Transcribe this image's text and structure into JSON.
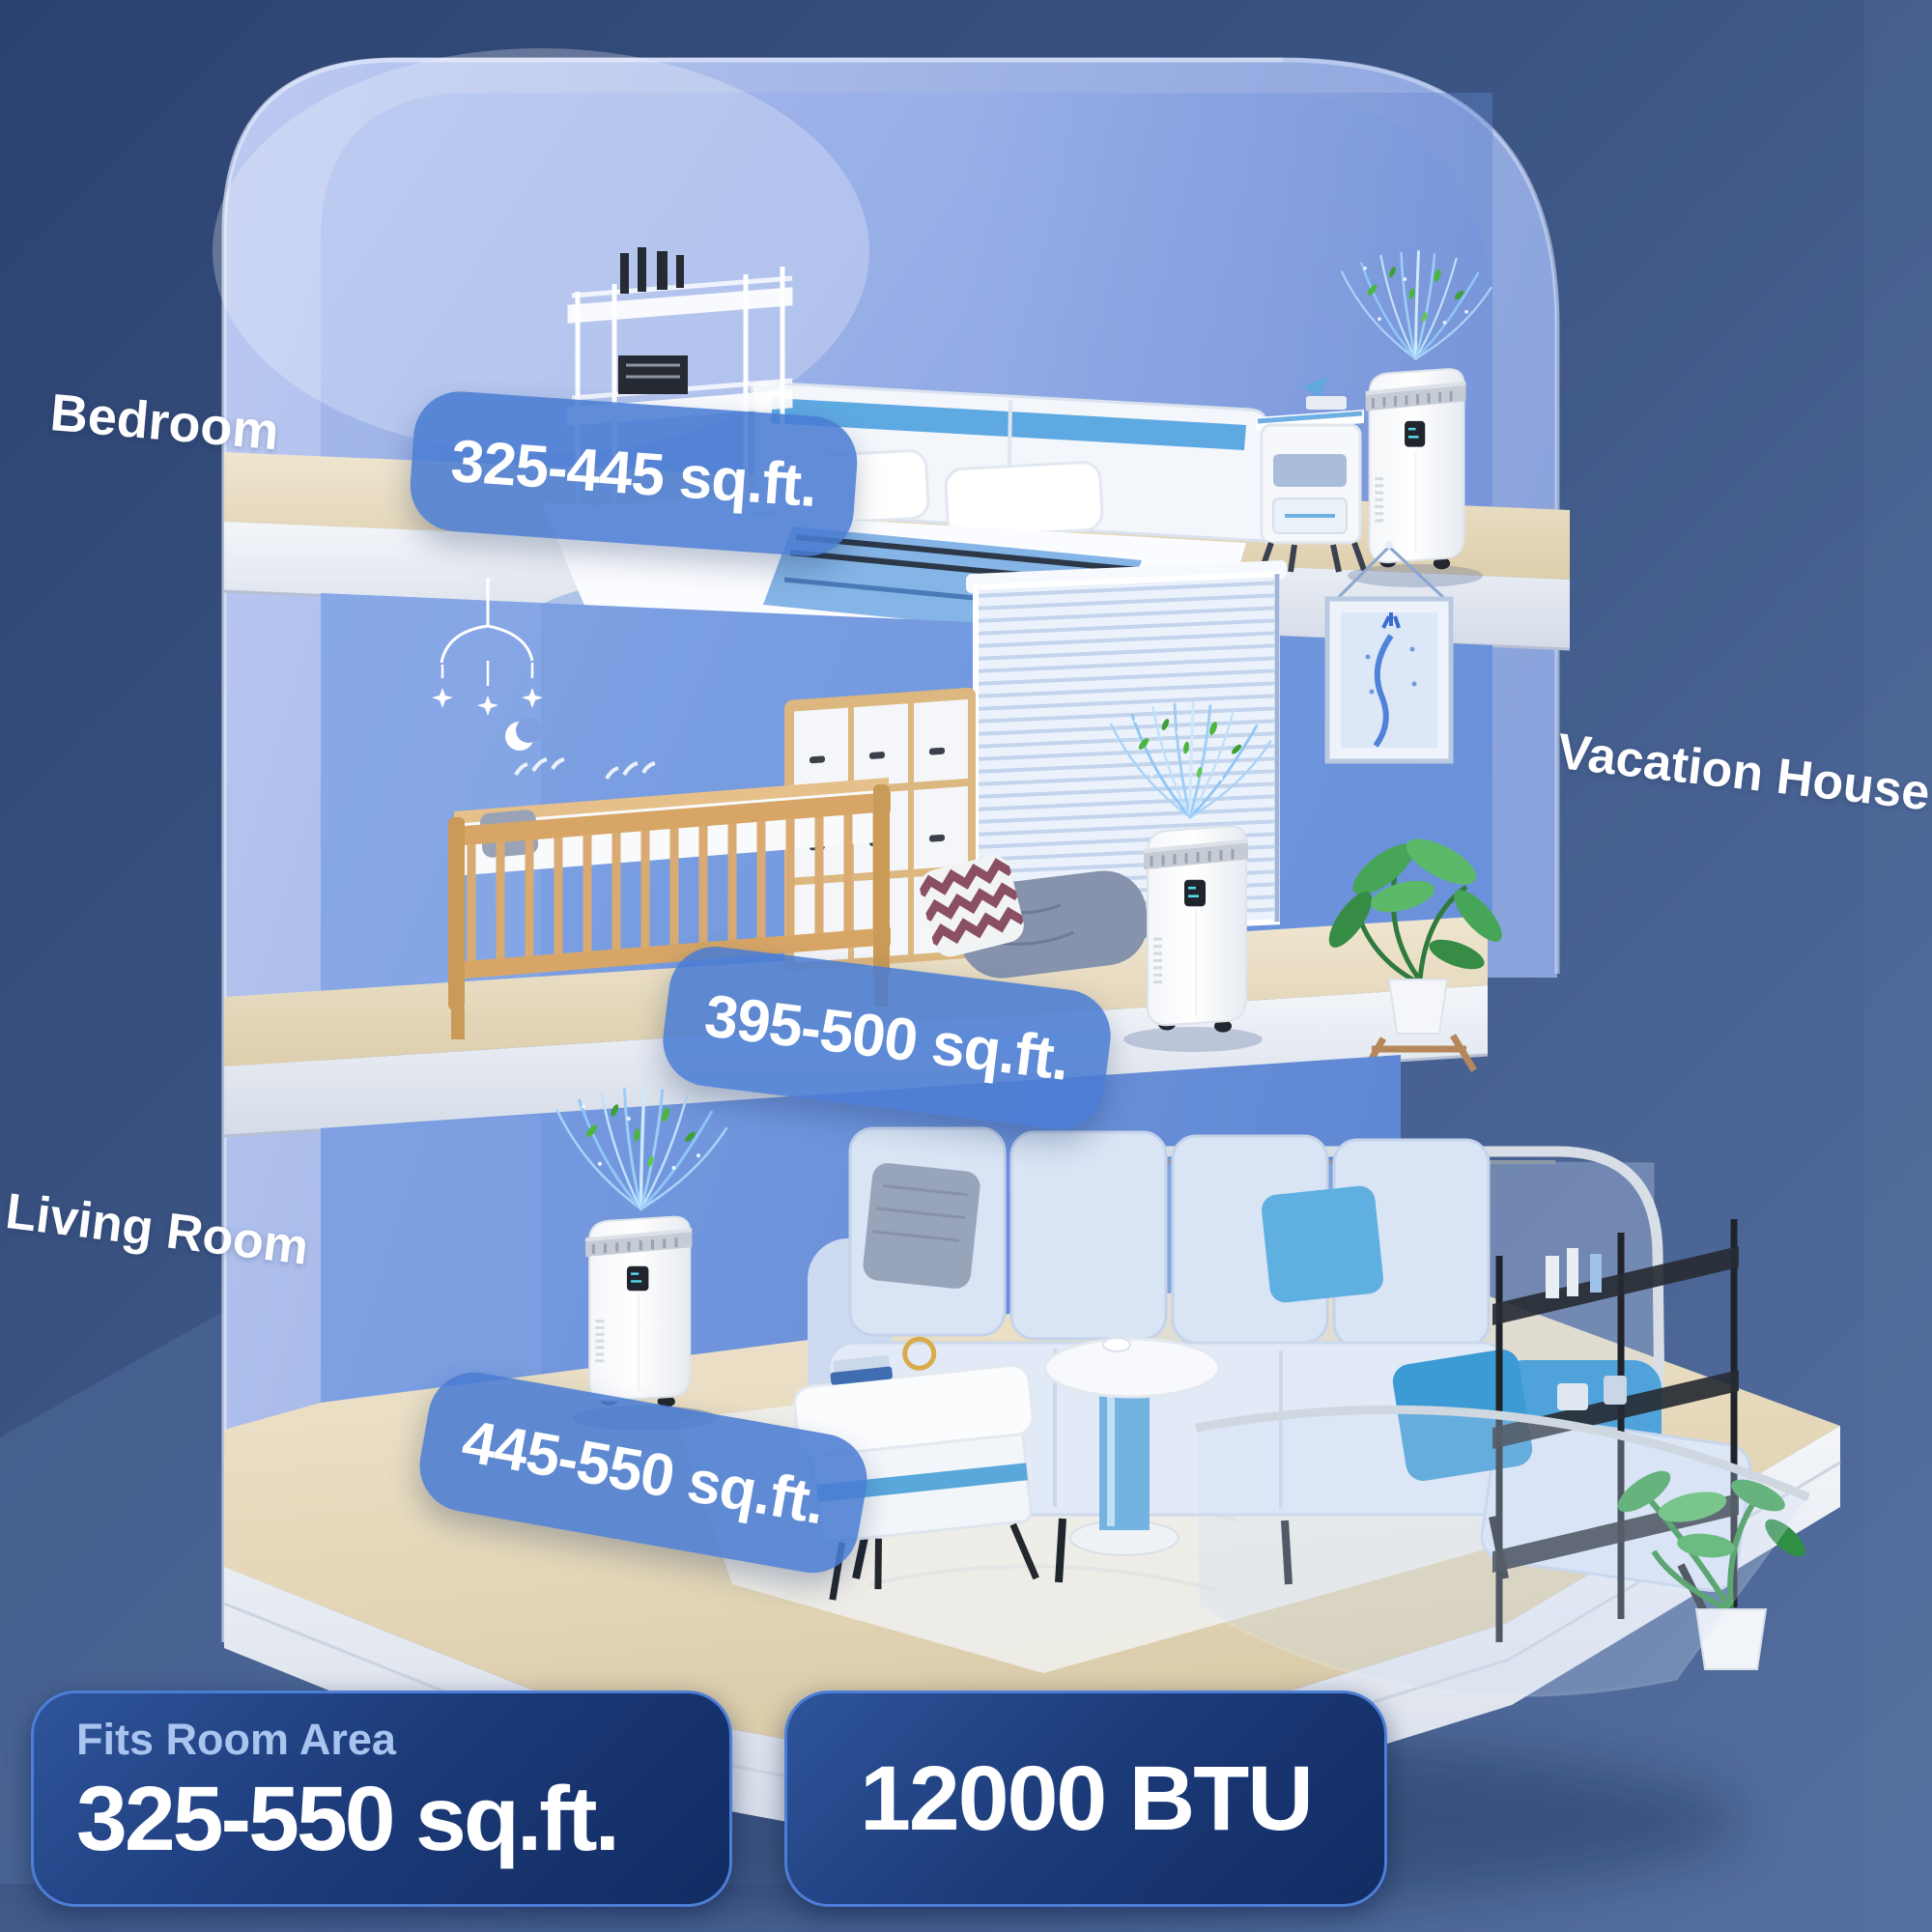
{
  "product": {
    "rooms": [
      {
        "name": "Bedroom",
        "area": "325-445 sq.ft."
      },
      {
        "name": "Vacation House",
        "area": "395-500 sq.ft."
      },
      {
        "name": "Living Room",
        "area": "445-550 sq.ft."
      }
    ],
    "fits": {
      "title": "Fits Room Area",
      "range": "325-550 sq.ft."
    },
    "btu": "12000 BTU"
  },
  "colors": {
    "background_navy": "#2d4472",
    "background_slate": "#4a6497",
    "house_wall_light": "#b7c7f0",
    "interior_wall_blue": "#7a9de2",
    "badge_blue": "#4a7cd2",
    "pill_navy": "#1b3a78",
    "pill_border_blue": "#4d7ed6",
    "airflow_blue": "#8ec6f6",
    "leaf_green": "#4ab63e",
    "wood_floor": "#e9dfc9"
  },
  "icons": {
    "airflow": "airflow-icon",
    "ac_unit": "portable-ac-unit"
  }
}
